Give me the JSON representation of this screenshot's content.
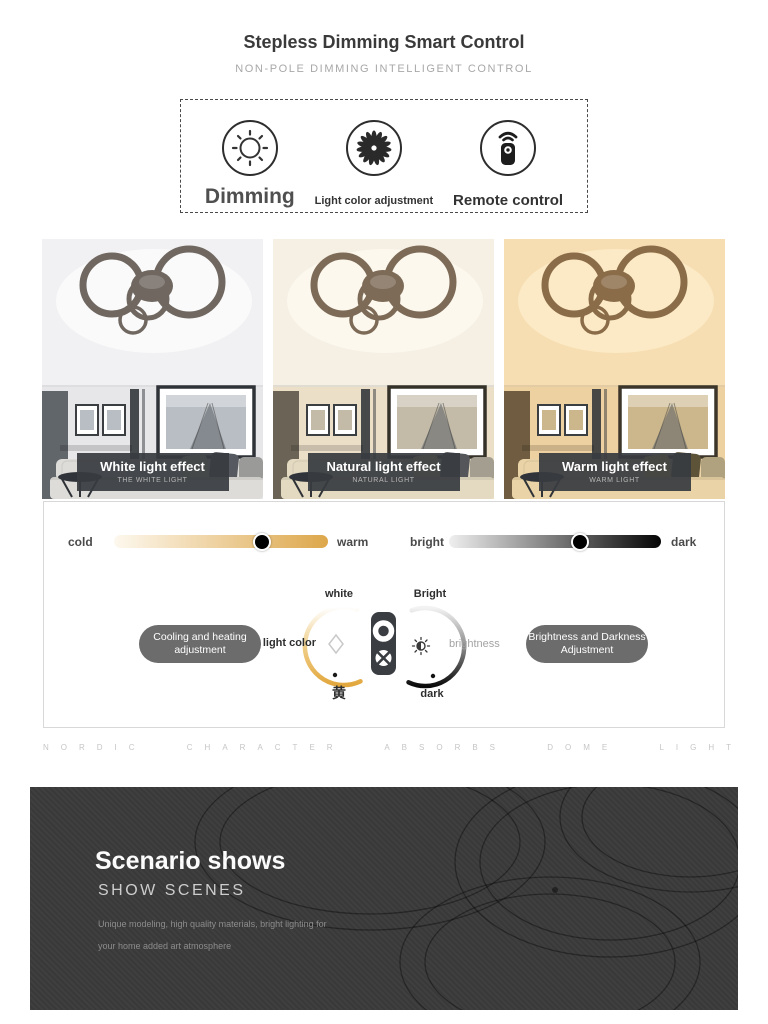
{
  "header": {
    "title": "Stepless Dimming Smart Control",
    "subtitle": "NON-POLE DIMMING INTELLIGENT CONTROL"
  },
  "features": {
    "items": [
      {
        "icon": "sun-icon",
        "label": "Dimming"
      },
      {
        "icon": "fan-icon",
        "label": "Light color adjustment"
      },
      {
        "icon": "remote-icon",
        "label": "Remote control"
      }
    ]
  },
  "light_effects": {
    "items": [
      {
        "title": "White light effect",
        "subtitle": "THE WHITE LIGHT",
        "colors": {
          "ceiling": "#f1f1f3",
          "glow": "#fbfbfc",
          "wall": "#e7e7e9",
          "walldark": "#61666b",
          "ring": "#6f6760",
          "frame": "#2f3237",
          "photo": "#b9bec4",
          "sofa": "#dddcd8",
          "pillow1": "#eeeac8",
          "pillow2": "#565a60",
          "pillow3": "#9a9a98"
        }
      },
      {
        "title": "Natural light effect",
        "subtitle": "NATURAL LIGHT",
        "colors": {
          "ceiling": "#f5efe4",
          "glow": "#fdf9f0",
          "wall": "#ecdfc8",
          "walldark": "#6b6356",
          "ring": "#7d6b57",
          "frame": "#343129",
          "photo": "#c3bba8",
          "sofa": "#e4dac2",
          "pillow1": "#efe0a0",
          "pillow2": "#54565a",
          "pillow3": "#a39e90"
        }
      },
      {
        "title": "Warm light effect",
        "subtitle": "WARM LIGHT",
        "colors": {
          "ceiling": "#f7ddb2",
          "glow": "#fcecc8",
          "wall": "#eed1a0",
          "walldark": "#705d41",
          "ring": "#8b6c49",
          "frame": "#3b352a",
          "photo": "#ccb78d",
          "sofa": "#ead3a6",
          "pillow1": "#f3d276",
          "pillow2": "#5d5338",
          "pillow3": "#b0a27e"
        }
      }
    ]
  },
  "control_panel": {
    "color_slider": {
      "left_label": "cold",
      "right_label": "warm",
      "knob_percent": 69,
      "start_color": "#fdf8ee",
      "end_color": "#dda74b"
    },
    "brightness_slider": {
      "left_label": "bright",
      "right_label": "dark",
      "knob_percent": 62,
      "start_color": "#efefef",
      "end_color": "#050505"
    },
    "color_dial": {
      "top_label": "white",
      "side_label": "light color",
      "bottom_label": "黄"
    },
    "brightness_dial": {
      "top_label": "Bright",
      "side_label": "brightness",
      "bottom_label": "dark"
    },
    "left_button": {
      "line1": "Cooling and heating",
      "line2": "adjustment"
    },
    "right_button": {
      "line1": "Brightness and Darkness",
      "line2": "Adjustment"
    }
  },
  "divider_caption": "NORDIC CHARACTER ABSORBS DOME LIGHT",
  "scenario": {
    "title": "Scenario shows",
    "subtitle": "SHOW SCENES",
    "description_line1": "Unique modeling, high quality materials, bright lighting for",
    "description_line2": "your home added art atmosphere",
    "bg_color": "#3b3b3b"
  }
}
